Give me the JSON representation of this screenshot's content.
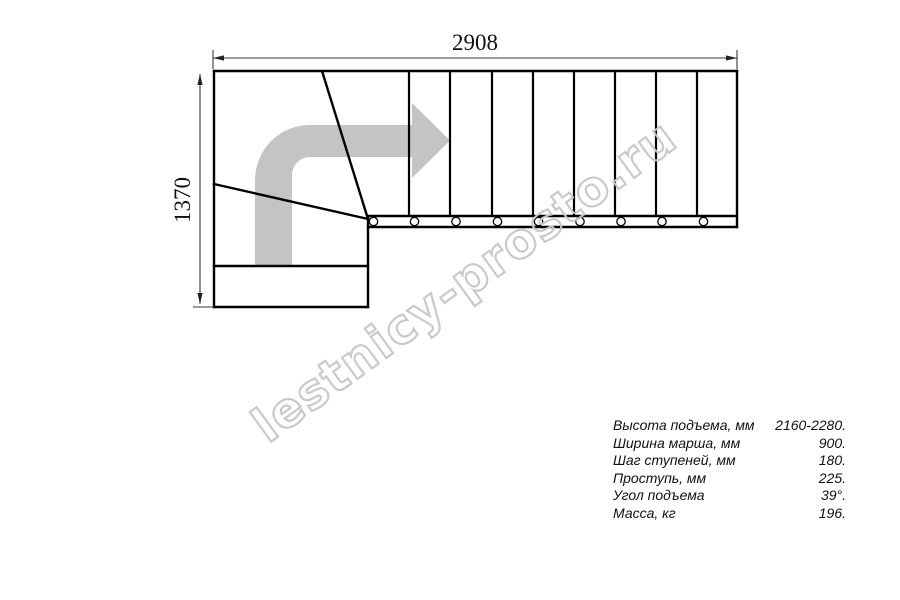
{
  "drawing": {
    "top_dimension_label": "2908",
    "left_dimension_label": "1370"
  },
  "watermark": {
    "text": "lestnicy-prosto.ru"
  },
  "specs": {
    "rows": [
      {
        "label": "Высота подъема, мм",
        "value": "2160-2280."
      },
      {
        "label": "Ширина марша, мм",
        "value": "900."
      },
      {
        "label": "Шаг ступеней, мм",
        "value": "180."
      },
      {
        "label": "Проступь, мм",
        "value": "225."
      },
      {
        "label": "Угол подъема",
        "value": "39°."
      },
      {
        "label": "Масса, кг",
        "value": "196."
      }
    ]
  },
  "colors": {
    "line": "#000000",
    "dimension": "#3a3a3a",
    "arrow_fill": "#c4c4c4",
    "watermark_outline": "#c8c8c8",
    "background": "#ffffff"
  }
}
